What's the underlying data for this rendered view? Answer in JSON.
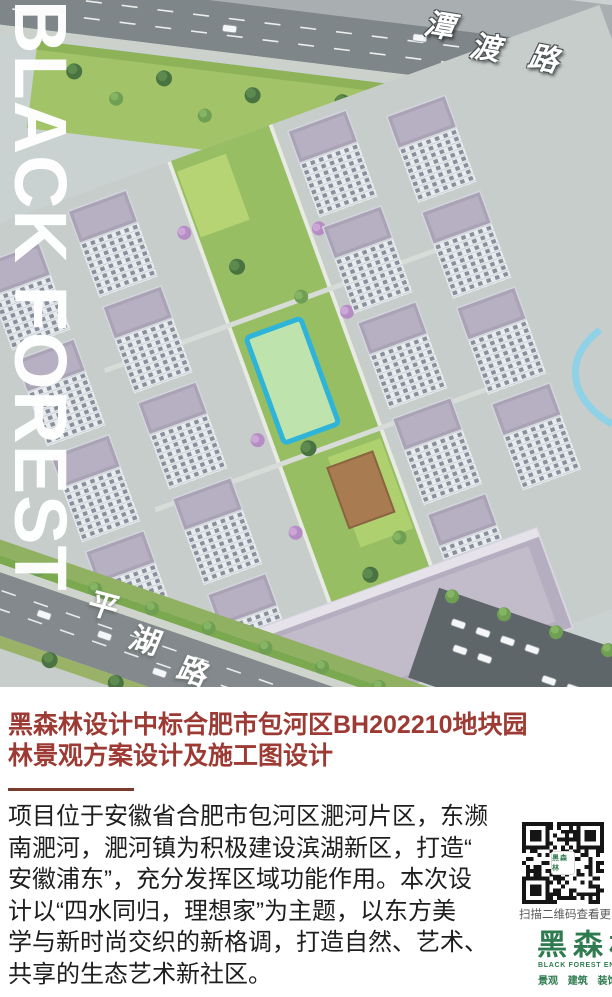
{
  "hero": {
    "watermark": "BLACK FOREST",
    "road_label_top": {
      "chars": [
        "潭",
        "渡",
        "路"
      ]
    },
    "road_label_bottom": {
      "chars": [
        "平",
        "湖",
        "路"
      ]
    }
  },
  "article": {
    "headline_lines": [
      "黑森林设计中标合肥市包河区BH202210地块园",
      "林景观方案设计及施工图设计"
    ],
    "headline_color": "#9d3a33",
    "divider_color": "#7b3a2b",
    "body_lines": [
      "项目位于安徽省合肥市包河区淝河片区，东濒",
      "南淝河，淝河镇为积极建设滨湖新区，打造“",
      "安徽浦东”，充分发挥区域功能作用。本次设",
      "计以“四水同归，理想家”为主题，以东方美",
      "学与新时尚交织的新格调，打造自然、艺术、",
      "共享的生态艺术新社区。"
    ]
  },
  "qr_panel": {
    "caption": "扫描二维码查看更多信息",
    "qr_center_label": "黑森林",
    "logo_text": "黑森林",
    "logo_subtitle_en": "BLACK FOREST ENVIRONMENT",
    "logo_tags": "景观 建筑 装饰 市政",
    "brand_green": "#2e7b4f"
  }
}
